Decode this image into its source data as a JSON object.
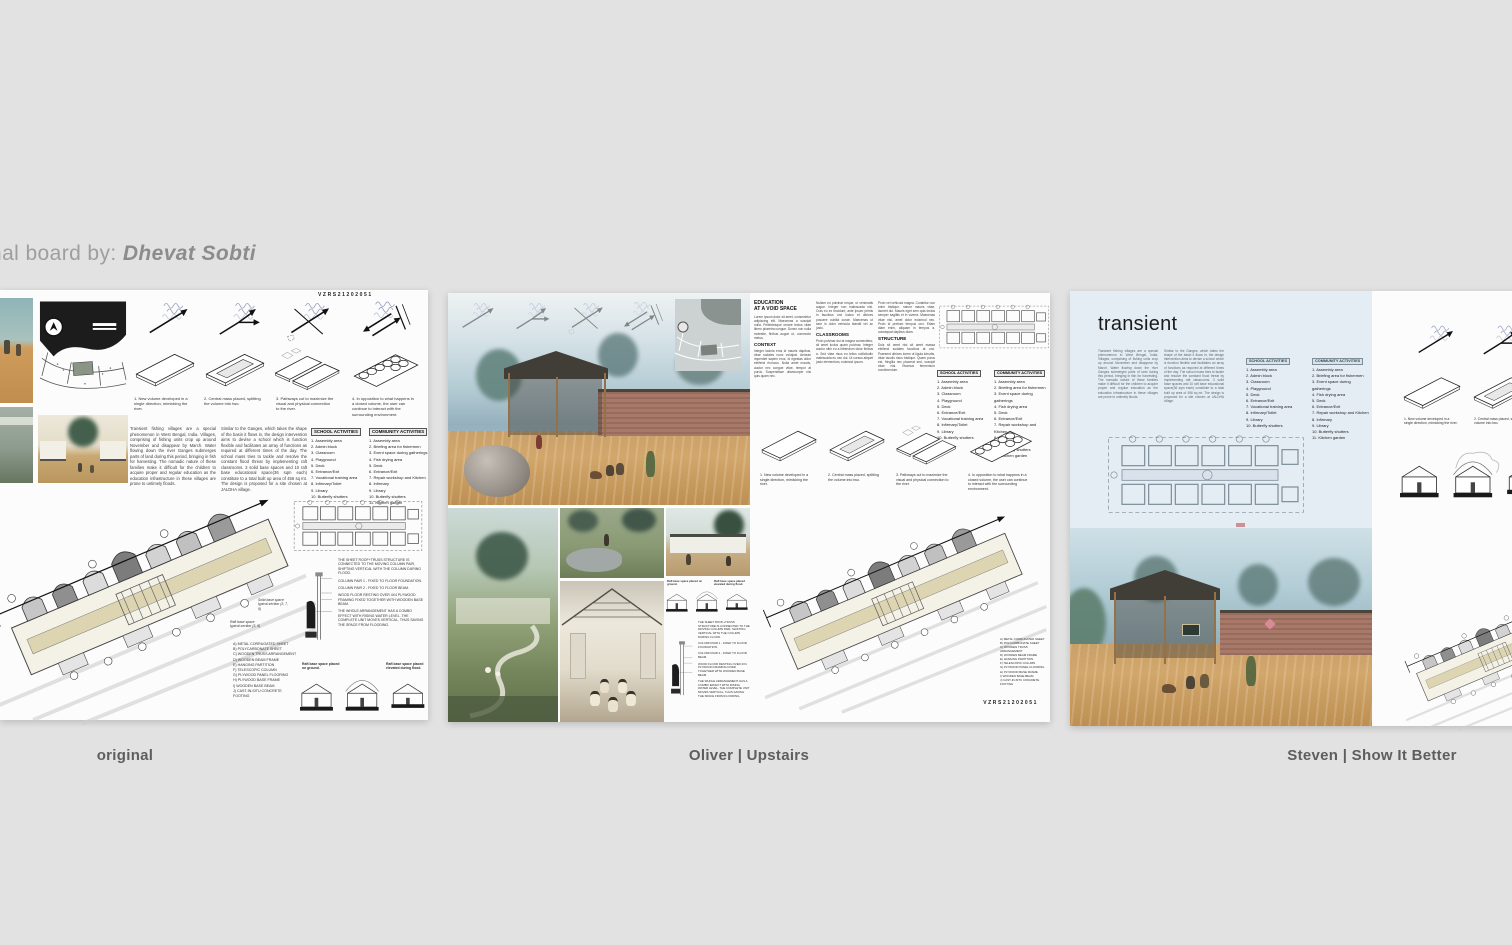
{
  "attribution": {
    "prefix": "nal board by: ",
    "author": "Dhevat Sobti"
  },
  "shared": {
    "board_code": "VZRS21202051",
    "diagram_captions": [
      "1. New volume developed in a single direction, mimicking the river.",
      "2. Central mass placed, splitting the volume into two.",
      "3. Pathways cut to maximize the visual and physical connection to the river.",
      "4. In opposition to what happens in a closed volume, the user can continue to interact with the surrounding environment."
    ],
    "school_activities": {
      "title": "SCHOOL ACTIVITIES",
      "items": [
        "1. Assembly area",
        "2. Admin block",
        "3. Classroom",
        "4. Playground",
        "5. Deck",
        "6. Entrance/Exit",
        "7. Vocational training area",
        "8. Infirmary/Toilet",
        "9. Library",
        "10. Butterfly shutters"
      ]
    },
    "community_activities": {
      "title": "COMMUNITY ACTIVITIES",
      "items": [
        "1. Assembly area",
        "2. Briefing area for fishermen",
        "3. Event space during gatherings",
        "4. Fish drying area",
        "5. Deck",
        "6. Entrance/Exit",
        "7. Repair workshop and Kitchen",
        "8. Infirmary",
        "9. Library",
        "10. Butterfly shutters",
        "11. Kitchen garden"
      ]
    },
    "intro_paragraph": "Transient fishing villages are a special phenomenon in West Bengal, India. Villages, comprising of fishing units crop up around November and disappear by March. Water flowing down the river Ganges submerges parts of land during this period, bringing in fish for harvesting. The nomadic nature of these families make it difficult for the children to acquire proper and regular education as the education infrastructure in these villages are prone to untimely floods.",
    "design_paragraph": "Similar to the Ganges, which takes the shape of the basin it flows in, the design intervention aims to devise a school which is function flexible and facilitates an array of functions as required at different times of the day. The school mass tries to tackle and resolve the constant flood threat by implementing raft classrooms. 3 solid base spaces and 10 raft base educational space(36 sqm each) constitute to a total built up area of 456 sq mt. The design is proposed for a site chosen at JALDHA village.",
    "construction_legend": [
      "A) METAL CORRUGATED SHEET",
      "B) POLYCARBONATE SHEET",
      "C) WOODEN TRUSS ARRANGEMENT",
      "D) WOODEN BEAM FRAME",
      "E) HANGING PARTITION",
      "F) TELESCOPIC COLUMN",
      "G) PLYWOOD PANEL FLOORING",
      "H) PLYWOOD BASE FRAME",
      "I) WOODEN BASE BEAM",
      "J) CAST-IN-SITU CONCRETE FOOTING"
    ],
    "section_notes": {
      "roof": "THE SHEET ROOF+TRUSS STRUCTURE IS CONNECTED TO THE MOVING COLUMN PAIR, SHIFTING VERTICAL WITH THE COLUMN DURING FLOOD.",
      "pair1": "COLUMN PAIR 1 - FIXED TO FLOOR FOUNDATION.",
      "pair2": "COLUMN PAIR 2 - FIXED TO FLOOR BEAM.",
      "floor": "WOOD FLOOR RESTING OVER 4X4 PLYWOOD FRAMING FIXED TOGETHER WITH WOODEN BASE BEAM.",
      "combo": "THE WHOLE ARRANGEMENT HAS A COMBO EFFECT WITH RISING WATER LEVEL. THE COMPLETE UNIT MOVES VERTICAL, THUS SAVING THE SPACE FROM FLOODING."
    },
    "typical_sections": {
      "solid": "Solid base space typical section (3, 7, 9)",
      "raft": "Raft base space typical section (3, 9)"
    },
    "raft_captions": {
      "ground": "Raft base space placed on ground.",
      "flood": "Raft base space placed elevated during flood."
    }
  },
  "board_original": {
    "label": "original"
  },
  "board_upstairs": {
    "label": "Oliver | Upstairs",
    "title_line1": "EDUCATION",
    "title_line2": "AT A VOID SPACE",
    "headers": {
      "context": "CONTEXT",
      "classrooms": "CLASSROOMS",
      "structure": "STRUCTURE"
    },
    "lorem": {
      "p1a": "Lorem ipsum dolor sit amet, consectetur adipiscing elit. Maecenas a suscipit nulla. Pellentesque ornare lectus vitae libero pharetra congue. Donec non nulla molestie, finibus augue ut, commodo metus.",
      "p1b": "Integer lacinia eros id mauris dapibus, vitae sodales nunc volutpat. Aenean imperdiet sapien eros, id egestas dolor eleifend rhoncus. Nulla amet mauris, auctor nec congue vitae, tempor at purus. Suspendisse ullamcorper nisi quis quam nec.",
      "p2a": "Nullam eu pulvinar neque, ut venenatis augue. Integer non malesuada nisi. Cras eu ex tincidunt, ante ipsum primis in faucibus orci luctus et ultrices posuere cubilia curae. Maecenas ut sem in dolor vehicula blandit vel ac justo.",
      "p2b": "Proin pulvinar dui at magna consectetur, sit amet luctus quam pulvinar. Integer auctor nibh eu a bibendum dolor finibus a. Sed vitae risus eu tellus sollicitudin malesuada eu nec dui. Ut cursus aliquet justo elementum, euismod ipsum.",
      "p3a": "Proin vel vehicula magna. Curabitur non enim tristique, rutrum mauris vitae, laoreet dui. Mauris eget sem quis lectus semper sagittis et in viverra. Maecenas vitae nisi, amet dolor euismod nec. Proin id pretium tempus orci. Etiam diam enim, aliquam in tempus a, consequat dapibus diam.",
      "p3b": "Duis sit amet nisi sit amet massa eleifend sodales faucibus at orci. Praesent ultrices lorem ut ligula lobortis, vitae iaculis risus tristique. Quam purus est, fringilla nec placerat sed, suscipit vitae nisi. Vivamus fermentum condimentum."
    }
  },
  "board_sib": {
    "label": "Steven | Show It Better",
    "title": "transient"
  }
}
